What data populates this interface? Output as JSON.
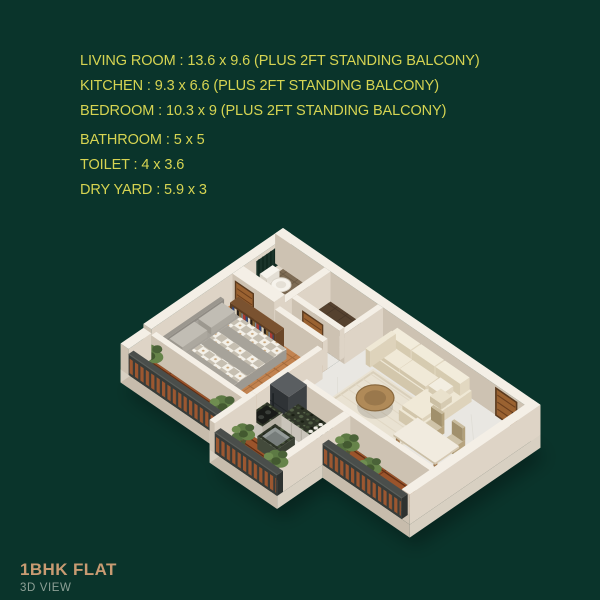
{
  "spec_list": {
    "lines": [
      "LIVING ROOM : 13.6 x 9.6 (PLUS 2FT STANDING BALCONY)",
      "KITCHEN : 9.3 x 6.6 (PLUS 2FT STANDING BALCONY)",
      "BEDROOM : 10.3 x 9 (PLUS 2FT STANDING BALCONY)",
      "BATHROOM : 5 x 5",
      "TOILET : 4 x 3.6",
      "DRY YARD : 5.9 x 3"
    ]
  },
  "footer": {
    "title": "1BHK FLAT",
    "subtitle": "3D VIEW"
  },
  "palette": {
    "background": "#0a342b",
    "spec_text": "#d6d452",
    "footer_title": "#c89b72",
    "footer_subtitle": "#8da096",
    "wall_top": "#f4efe6",
    "wall_light": "#ded4c6",
    "wall_shadow": "#cdc2b2",
    "marble_floor": "#e9e7e2",
    "wood_floor": "#c28350",
    "deck_wood": "#9b542b",
    "toilet_tile": "#7d6b54",
    "bath_tile": "#55412e",
    "granite": "#2f3528",
    "sofa_cream": "#efe8d5",
    "rug": "#e9e2d2",
    "rail_slat": "#9c5730",
    "door_wood": "#9a6231",
    "plant_green": "#66844a",
    "fridge_gray": "#3d4144"
  }
}
